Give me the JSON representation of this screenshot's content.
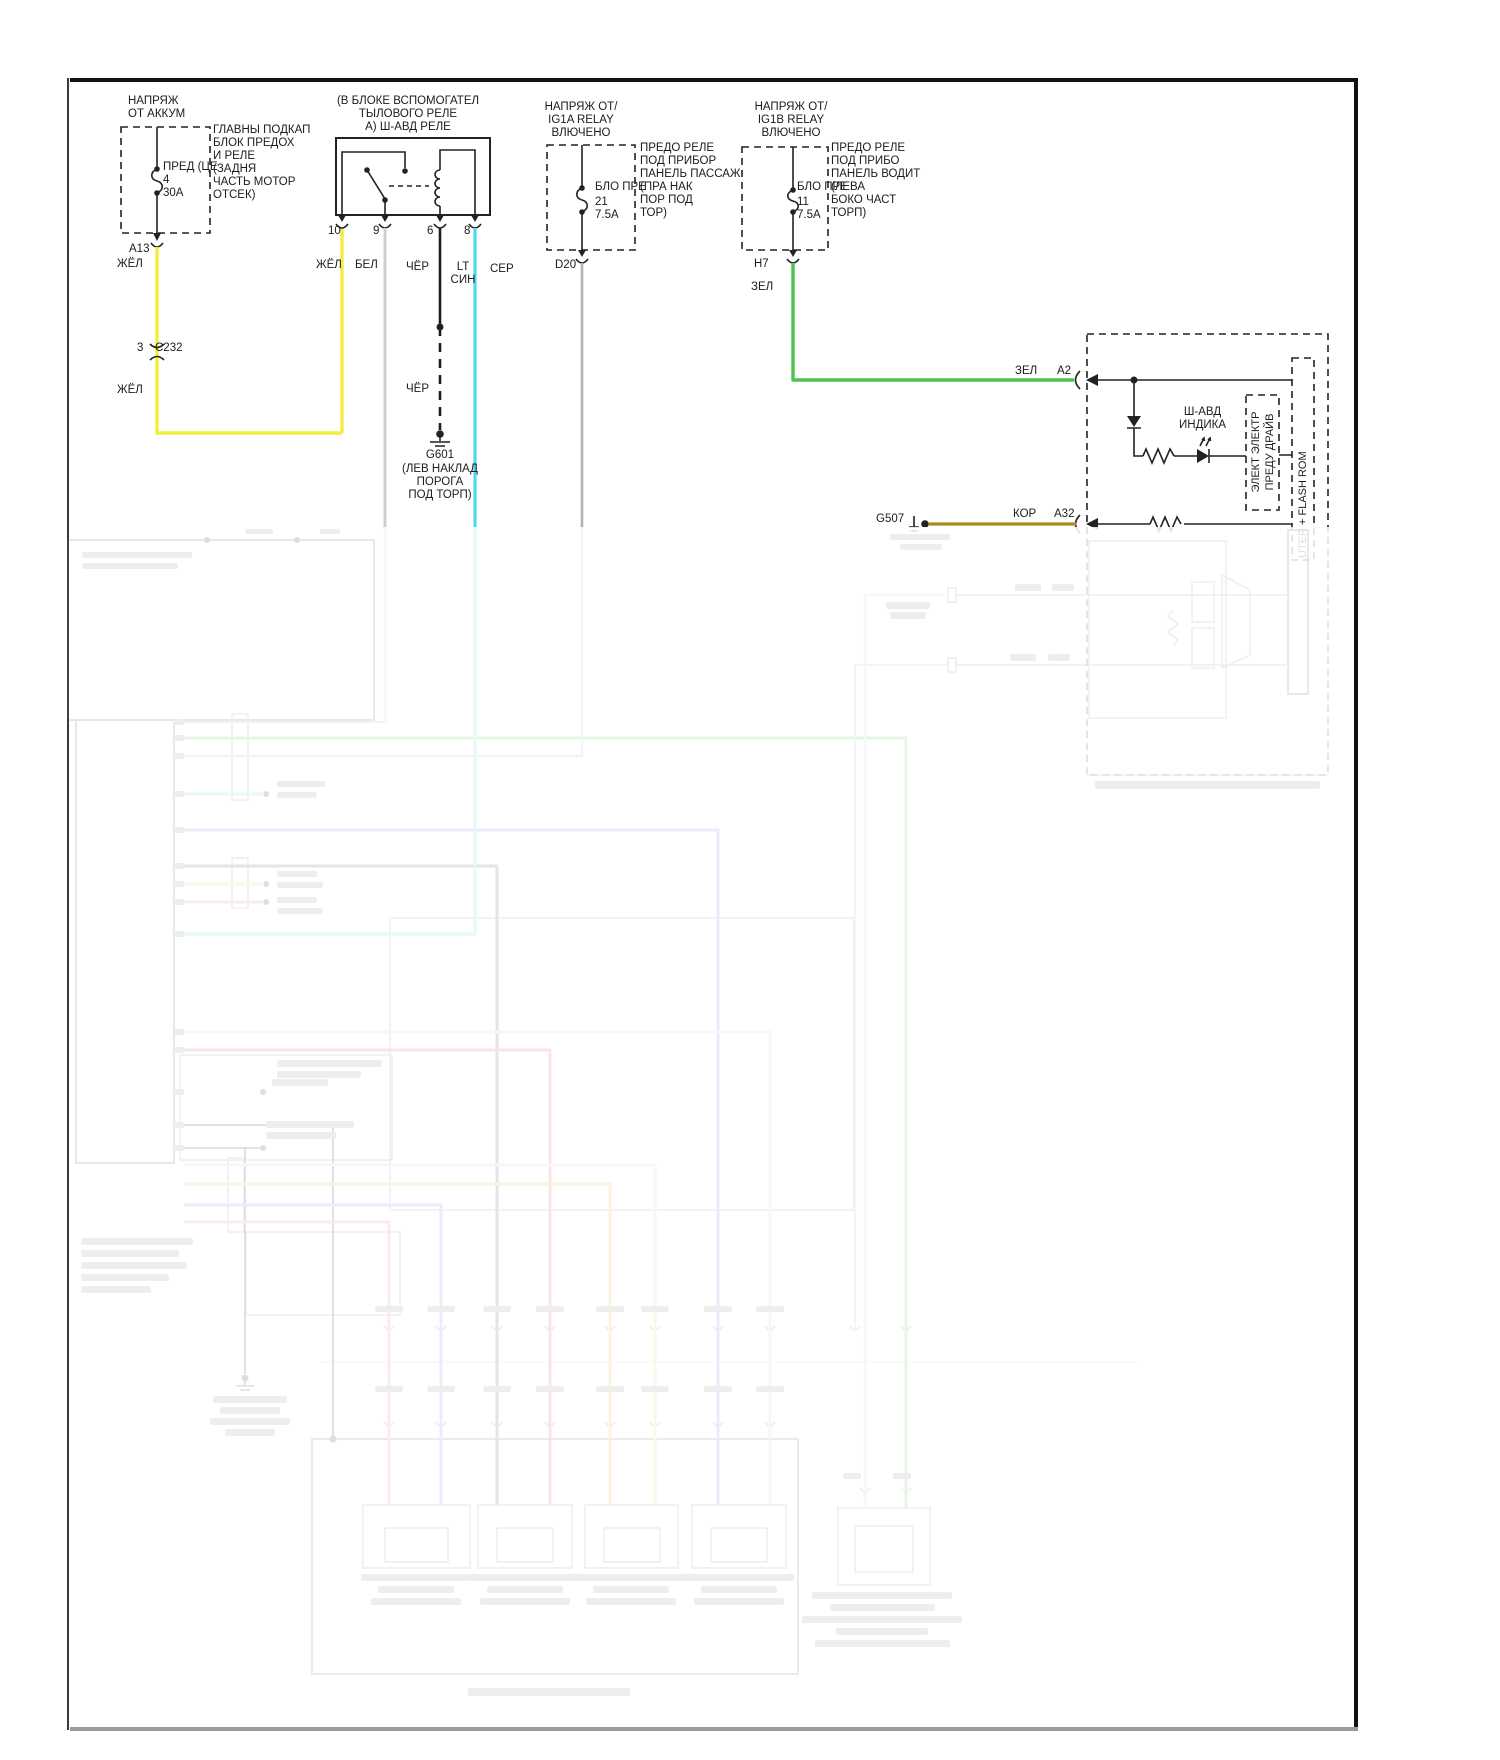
{
  "colors": {
    "yellow": "#f2ee3f",
    "white_wire": "#cfcfcf",
    "black_wire": "#1e1e1e",
    "ltblue": "#4fd9ee",
    "gray": "#b3b3b3",
    "green": "#4fc24f",
    "brown": "#a88c1f",
    "violet": "#7b7bea",
    "red": "#e4495b",
    "pink": "#e87a88",
    "orange": "#f2a33c",
    "pale_yellow": "#ded36e",
    "light_gray": "#c8c8c8",
    "dark_gray": "#555555"
  },
  "battery": {
    "header": "НАПРЯЖ\nОТ АККУМ",
    "fuse_label": "ПРЕД (ЦЕ\n4\n30A",
    "box_label": "ГЛАВНЫ ПОДКАП\nБЛОК ПРЕДОХ\nИ РЕЛЕ\n(ЗАДНЯ\nЧАСТЬ МОТОР\nОТСЕК)",
    "connector": "A13",
    "wire": "ЖЁЛ",
    "splice_pin": "3",
    "splice": "C232",
    "wire2": "ЖЁЛ"
  },
  "relay": {
    "title": "(В БЛОКЕ ВСПОМОГАТЕЛ\nТЫЛОВОГО РЕЛЕ\nА) Ш-АВД РЕЛЕ",
    "p10": "10",
    "p9": "9",
    "p6": "6",
    "p8": "8",
    "wire_yellow": "ЖЁЛ",
    "wire_white": "БЕЛ",
    "wire_black": "ЧЁР",
    "wire_ltblue": "LT\nСИН",
    "wire_black2": "ЧЁР",
    "ground": "G601",
    "ground_label": "(ЛЕВ НАКЛАД\nПОРОГА\nПОД ТОРП)"
  },
  "ig1a": {
    "header": "НАПРЯЖ ОТ/\nIG1A RELAY\nВЛЮЧЕНО",
    "fuse_name": "БЛО ПРЕ",
    "fuse_amps": "21\n7.5A",
    "side_label": "ПРЕДО РЕЛЕ\nПОД ПРИБОР\nПАНЕЛЬ ПАССАЖ\n(ПРА НАК\nПОР ПОД\nТОР)",
    "connector": "D20",
    "wire": "СЕР"
  },
  "ig1b": {
    "header": "НАПРЯЖ ОТ/\nIG1B RELAY\nВЛЮЧЕНО",
    "fuse_name": "БЛО ПРЕ",
    "fuse_amps": "11\n7.5A",
    "side_label": "ПРЕДО РЕЛЕ\nПОД ПРИБО\nПАНЕЛЬ ВОДИТ\n(ЛЕВА\nБОКО ЧАСТ\nТОРП)",
    "connector": "H7",
    "wire": "ЗЕЛ"
  },
  "abs_module": {
    "wire_green": "ЗЕЛ",
    "pin_a2": "A2",
    "indicator": "Ш-АВД\nИНДИКА",
    "driver_box": "ЭЛЕКТ ЭЛЕКТР\nПРЕДУ ДРАЙВ",
    "rom_box": "UTER + FLASH ROM",
    "ground": "G507",
    "wire_brown": "КОР",
    "pin_a32": "A32"
  }
}
